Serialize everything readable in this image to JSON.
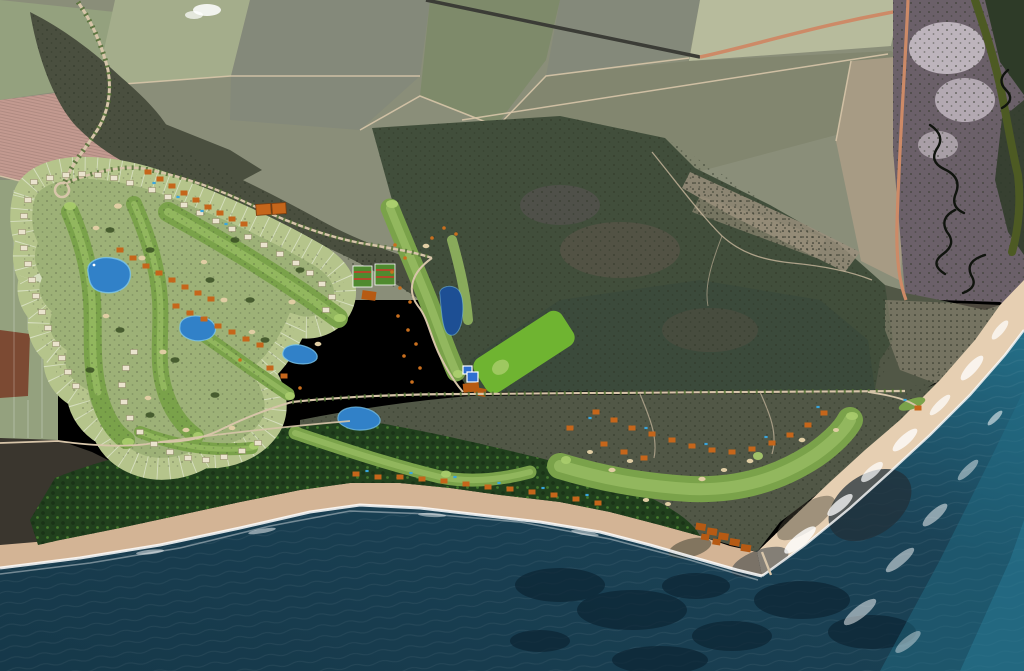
{
  "scene": {
    "kind": "aerial-satellite-masterplan",
    "legend": {
      "ocean": "ocean",
      "beach": "beach",
      "surf": "surf-foam",
      "reef": "submerged-reef",
      "palm_forest": "coastal-palm-plantation",
      "fields": "agricultural-fields",
      "scrub": "dry-scrub-forest",
      "estuary": "tidal-estuary",
      "river": "river-channel",
      "golf_west": "western-golf-course-with-villa-ring",
      "golf_center": "practice-area-and-driving-range",
      "golf_east": "coastal-golf-holes",
      "clubhouse": "clubhouse-with-pools",
      "villas": "resort-villas",
      "roads": "access-roads"
    }
  },
  "colors": {
    "field_base": "#8a8e79",
    "field_green": "#94a17e",
    "field_light": "#a4ad8b",
    "field_pale": "#b7bb9c",
    "field_pink": "#c39a90",
    "field_tan": "#a79b84",
    "field_gray": "#84897a",
    "field_olive": "#7e8a6a",
    "field_murk": "#82866f",
    "field_rust": "#7c4a33",
    "scrub_dark": "#4a4f3f",
    "scrub_green": "#515746",
    "scrub_west": "#3a362e",
    "scrub_purple": "#6b6069",
    "forest_dark": "#414e3b",
    "forest_teal": "#37473d",
    "clump_green": "#33491f",
    "speckle": "#2d3526",
    "orchard_base": "#9a8f7c",
    "orchard_dot": "#1c2018",
    "palm_forest": "#21401d",
    "palm_dark": "#1a3317",
    "palm_crown": "#447a2c",
    "saltflat": "#d2c9d1",
    "river_olive": "#4d5a23",
    "creek_black": "#10140e",
    "mangrove": "#2e3b28",
    "road_salmon": "#cd8a67",
    "road_dirt": "#d7c5a9",
    "road_track": "#c9b89e",
    "road_dark": "#3b3c36",
    "avenue_green": "#4c6a31",
    "beach_west": "#d3b495",
    "beach_east": "#e6cfb2",
    "surf": "#ffffff",
    "ocean_deep": "#163849",
    "ocean_mid": "#1b4357",
    "ocean_teal": "#247089",
    "ocean_bright": "#2e8aa5",
    "ocean_reef": "#0c2433",
    "rock_dark": "#223039",
    "rock_brown": "#323629",
    "rough": "#9db177",
    "lawn": "#b5c48b",
    "fairway": "#7aa24a",
    "fairway_light": "#97bb62",
    "green_putting": "#aacd6d",
    "range_green": "#6fb431",
    "bunker": "#e0cda3",
    "lake": "#3181c8",
    "lake_light": "#7cc4ea",
    "lake_deep": "#1d4f94",
    "villa_orange": "#c5661b",
    "building_orange": "#b65a13",
    "house_white": "#eae3cd",
    "house_edge": "#8f8566",
    "pool_blue": "#3aa5dc",
    "clubhouse_blue": "#2f6fd0",
    "grid_green": "#4f8a2f",
    "grid_red": "#b04b2b",
    "orange_tree": "#c96f1e",
    "cloud": "#ffffff"
  }
}
